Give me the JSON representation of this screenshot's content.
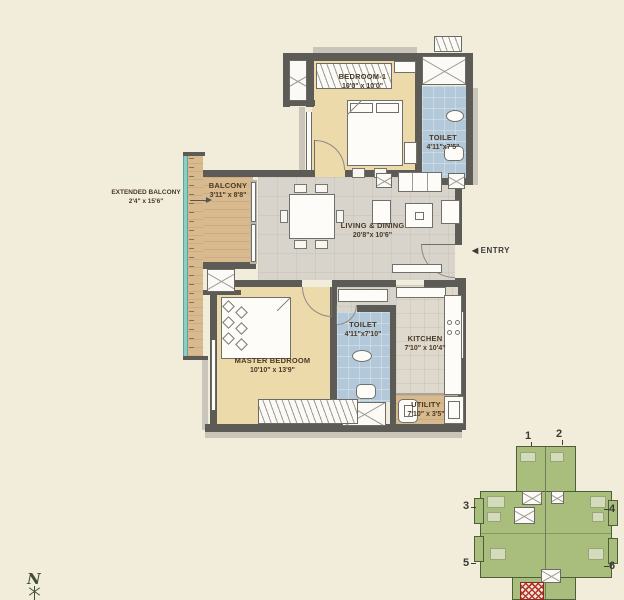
{
  "rooms": [
    {
      "name": "BEDROOM-1",
      "dims": "10'0\" x 10'0\""
    },
    {
      "name": "TOILET",
      "dims": "4'11\"x7'5\""
    },
    {
      "name": "BALCONY",
      "dims": "3'11\" x 8'8\""
    },
    {
      "name": "EXTENDED BALCONY",
      "dims": "2'4\" x 15'6\""
    },
    {
      "name": "LIVING & DINING",
      "dims": "20'8\"x 10'6\""
    },
    {
      "name": "MASTER BEDROOM",
      "dims": "10'10\" x 13'9\""
    },
    {
      "name": "TOILET",
      "dims": "4'11\"x7'10\""
    },
    {
      "name": "KITCHEN",
      "dims": "7'10\" x 10'4\""
    },
    {
      "name": "UTILITY",
      "dims": "7'10\" x 3'5\""
    }
  ],
  "entry": {
    "arrow": "◀",
    "label": "ENTRY"
  },
  "compass": {
    "label": "N"
  },
  "keyplan": {
    "units": [
      "1",
      "2",
      "3",
      "4",
      "5",
      "6"
    ]
  },
  "colors": {
    "background": "#f2ecdb",
    "wall": "#5d5b55",
    "bedroom_floor": "#eddaab",
    "toilet_floor": "#b3c9d9",
    "living_floor": "#d8d4cb",
    "balcony_floor": "#d9ba8e",
    "glass": "#8fccc2",
    "keyplan_green": "#a9bd7c",
    "highlight_red": "#b5352b"
  }
}
